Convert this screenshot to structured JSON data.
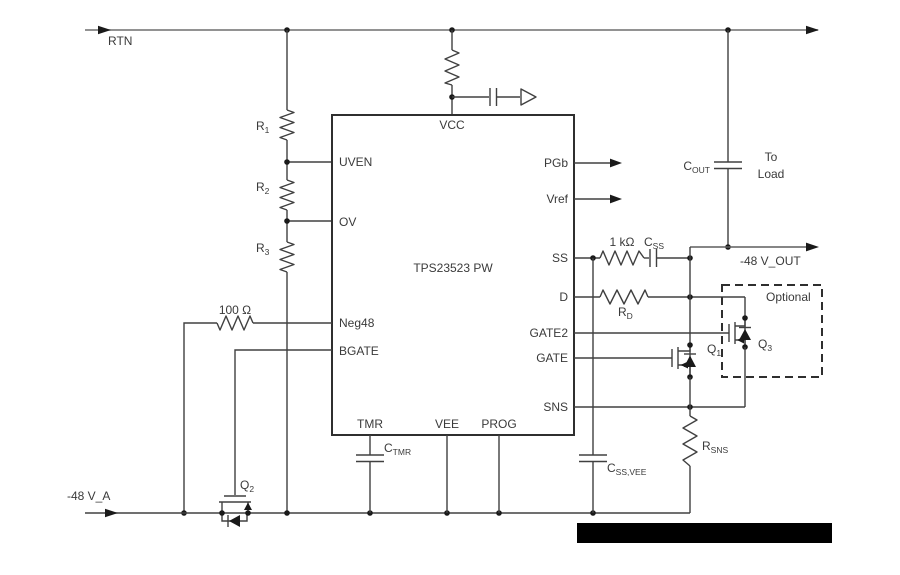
{
  "chip": {
    "name": "TPS23523 PW",
    "pins": {
      "vcc": "VCC",
      "uven": "UVEN",
      "ov": "OV",
      "neg48": "Neg48",
      "bgate": "BGATE",
      "tmr": "TMR",
      "vee": "VEE",
      "prog": "PROG",
      "pgb": "PGb",
      "vref": "Vref",
      "ss": "SS",
      "d": "D",
      "gate2": "GATE2",
      "gate": "GATE",
      "sns": "SNS"
    }
  },
  "nets": {
    "rtn": "RTN",
    "input": "-48 V_A",
    "output": "-48 V_OUT",
    "load_line1": "To",
    "load_line2": "Load",
    "optional": "Optional"
  },
  "components": {
    "r1": {
      "ref": "R",
      "sub": "1"
    },
    "r2": {
      "ref": "R",
      "sub": "2"
    },
    "r3": {
      "ref": "R",
      "sub": "3"
    },
    "r_neg48": "100 Ω",
    "r_ss": "1 kΩ",
    "c_ss": {
      "ref": "C",
      "sub": "SS"
    },
    "r_d": {
      "ref": "R",
      "sub": "D"
    },
    "c_out": {
      "ref": "C",
      "sub": "OUT"
    },
    "r_sns": {
      "ref": "R",
      "sub": "SNS"
    },
    "c_ss_vee": {
      "ref": "C",
      "sub": "SS,VEE"
    },
    "c_tmr": {
      "ref": "C",
      "sub": "TMR"
    },
    "q1": {
      "ref": "Q",
      "sub": "1"
    },
    "q2": {
      "ref": "Q",
      "sub": "2"
    },
    "q3": {
      "ref": "Q",
      "sub": "3"
    }
  },
  "colors": {
    "wire": "#404040",
    "rail": "#6f6f6f",
    "text": "#3a3a3a",
    "background": "#ffffff",
    "redaction": "#000000"
  }
}
